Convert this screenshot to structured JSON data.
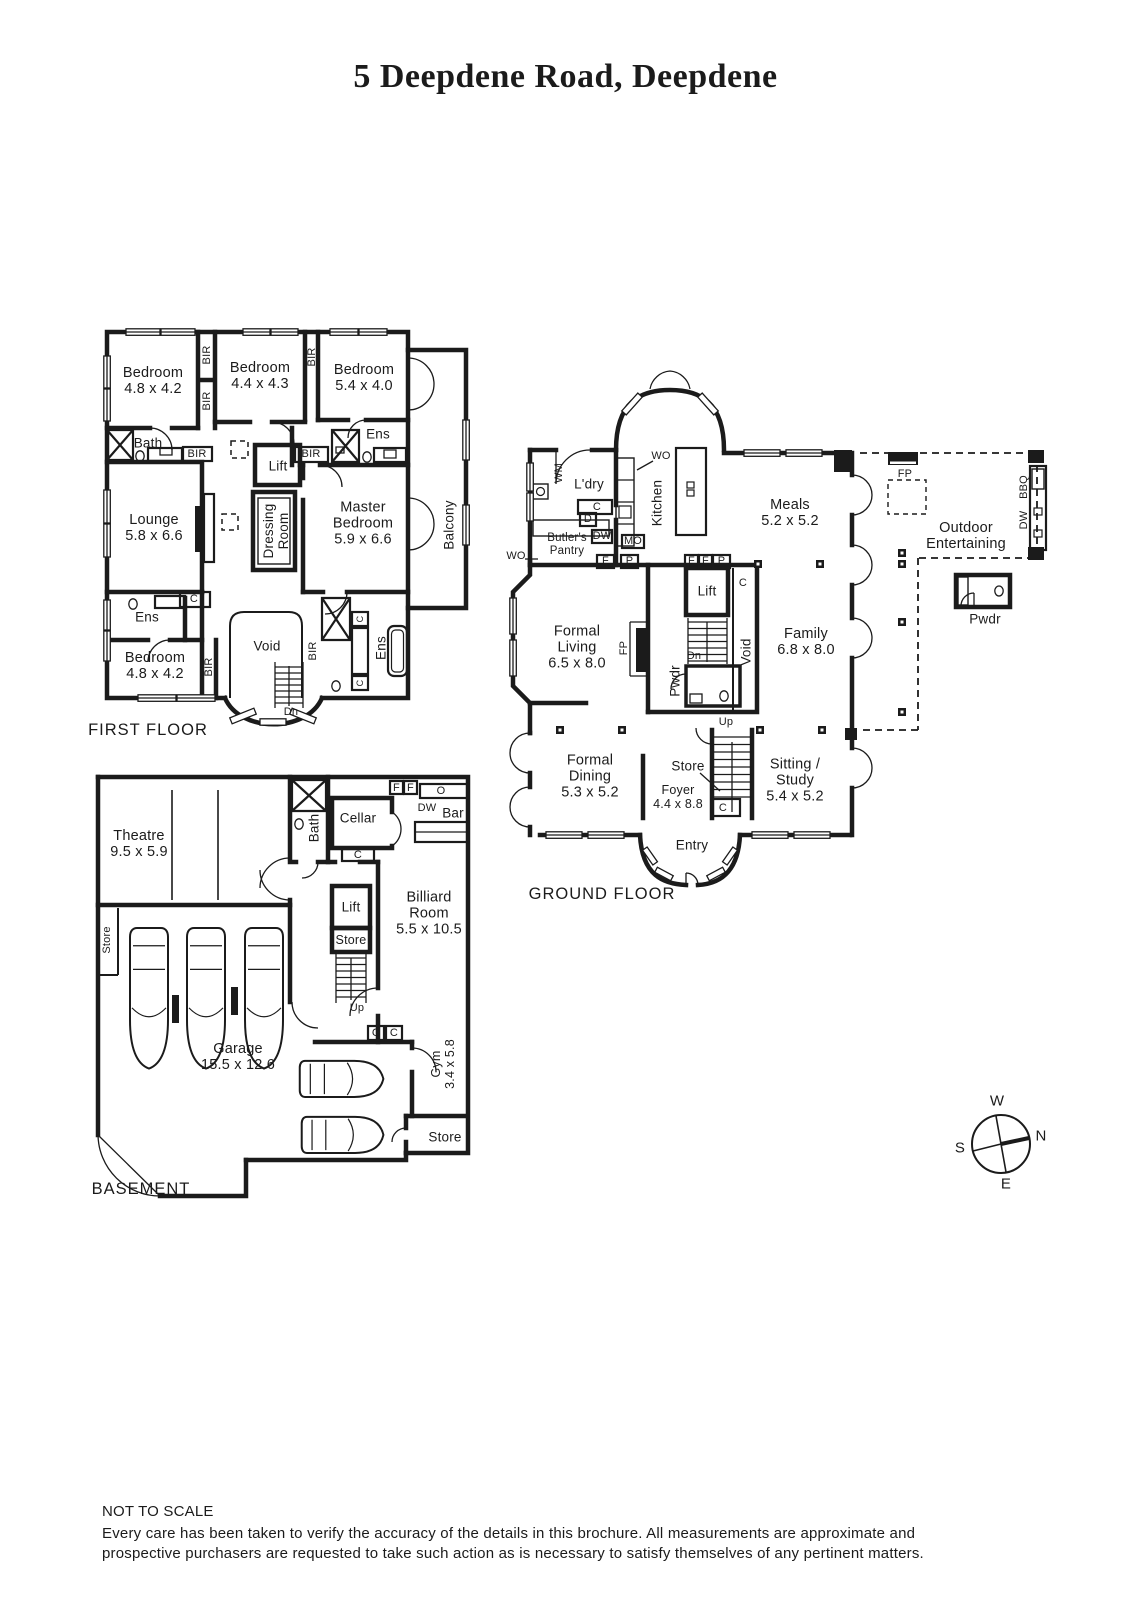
{
  "title": "5 Deepdene Road, Deepdene",
  "ff": {
    "caption": "FIRST FLOOR",
    "bedroom_nw": {
      "name": "Bedroom",
      "dims": "4.8 x 4.2"
    },
    "bedroom_n": {
      "name": "Bedroom",
      "dims": "4.4 x 4.3"
    },
    "bedroom_ne": {
      "name": "Bedroom",
      "dims": "5.4 x 4.0"
    },
    "bedroom_sw": {
      "name": "Bedroom",
      "dims": "4.8 x 4.2"
    },
    "master": {
      "name": "Master Bedroom",
      "dims": "5.9 x 6.6"
    },
    "lounge": {
      "name": "Lounge",
      "dims": "5.8 x 6.6"
    },
    "dressing_room": "Dressing Room",
    "balcony": "Balcony",
    "bath": "Bath",
    "ens": "Ens",
    "lift": "Lift",
    "void": "Void",
    "bir": "BIR",
    "c": "C",
    "dn": "Dn"
  },
  "gf": {
    "caption": "GROUND FLOOR",
    "ldry": "L'dry",
    "wm": "WM",
    "wo": "WO",
    "mo": "MO",
    "dw": "DW",
    "d": "D",
    "f": "F",
    "p": "P",
    "c": "C",
    "butlers_pantry": "Butler's Pantry",
    "kitchen": "Kitchen",
    "meals": {
      "name": "Meals",
      "dims": "5.2 x 5.2"
    },
    "family": {
      "name": "Family",
      "dims": "6.8 x 8.0"
    },
    "formal_living": {
      "name": "Formal Living",
      "dims": "6.5 x 8.0"
    },
    "formal_dining": {
      "name": "Formal Dining",
      "dims": "5.3 x 5.2"
    },
    "sitting_study": {
      "name": "Sitting / Study",
      "dims": "5.4 x 5.2"
    },
    "foyer": {
      "name": "Foyer",
      "dims": "4.4 x 8.8"
    },
    "outdoor": {
      "line1": "Outdoor",
      "line2": "Entertaining"
    },
    "fp": "FP",
    "bbq": "BBQ",
    "pwdr": "Pwdr",
    "lift": "Lift",
    "void": "Void",
    "store": "Store",
    "entry": "Entry",
    "up": "Up",
    "dn": "Dn"
  },
  "bm": {
    "caption": "BASEMENT",
    "theatre": {
      "name": "Theatre",
      "dims": "9.5 x 5.9"
    },
    "billiard": {
      "name": "Billiard Room",
      "dims": "5.5 x 10.5"
    },
    "garage": {
      "name": "Garage",
      "dims": "15.5 x 12.6"
    },
    "gym": {
      "name": "Gym",
      "dims": "3.4 x 5.8"
    },
    "bath": "Bath",
    "cellar": "Cellar",
    "bar": "Bar",
    "lift": "Lift",
    "store": "Store",
    "dw": "DW",
    "o": "O",
    "f": "F",
    "c": "C",
    "up": "Up"
  },
  "compass": {
    "n": "N",
    "e": "E",
    "s": "S",
    "w": "W"
  },
  "footer": {
    "scale_note": "NOT TO SCALE",
    "disclaimer_line1": "Every care has been taken to verify the accuracy of the details in this brochure. All measurements are approximate and",
    "disclaimer_line2": "prospective purchasers are requested to take such action as is necessary to satisfy themselves of any pertinent matters."
  }
}
